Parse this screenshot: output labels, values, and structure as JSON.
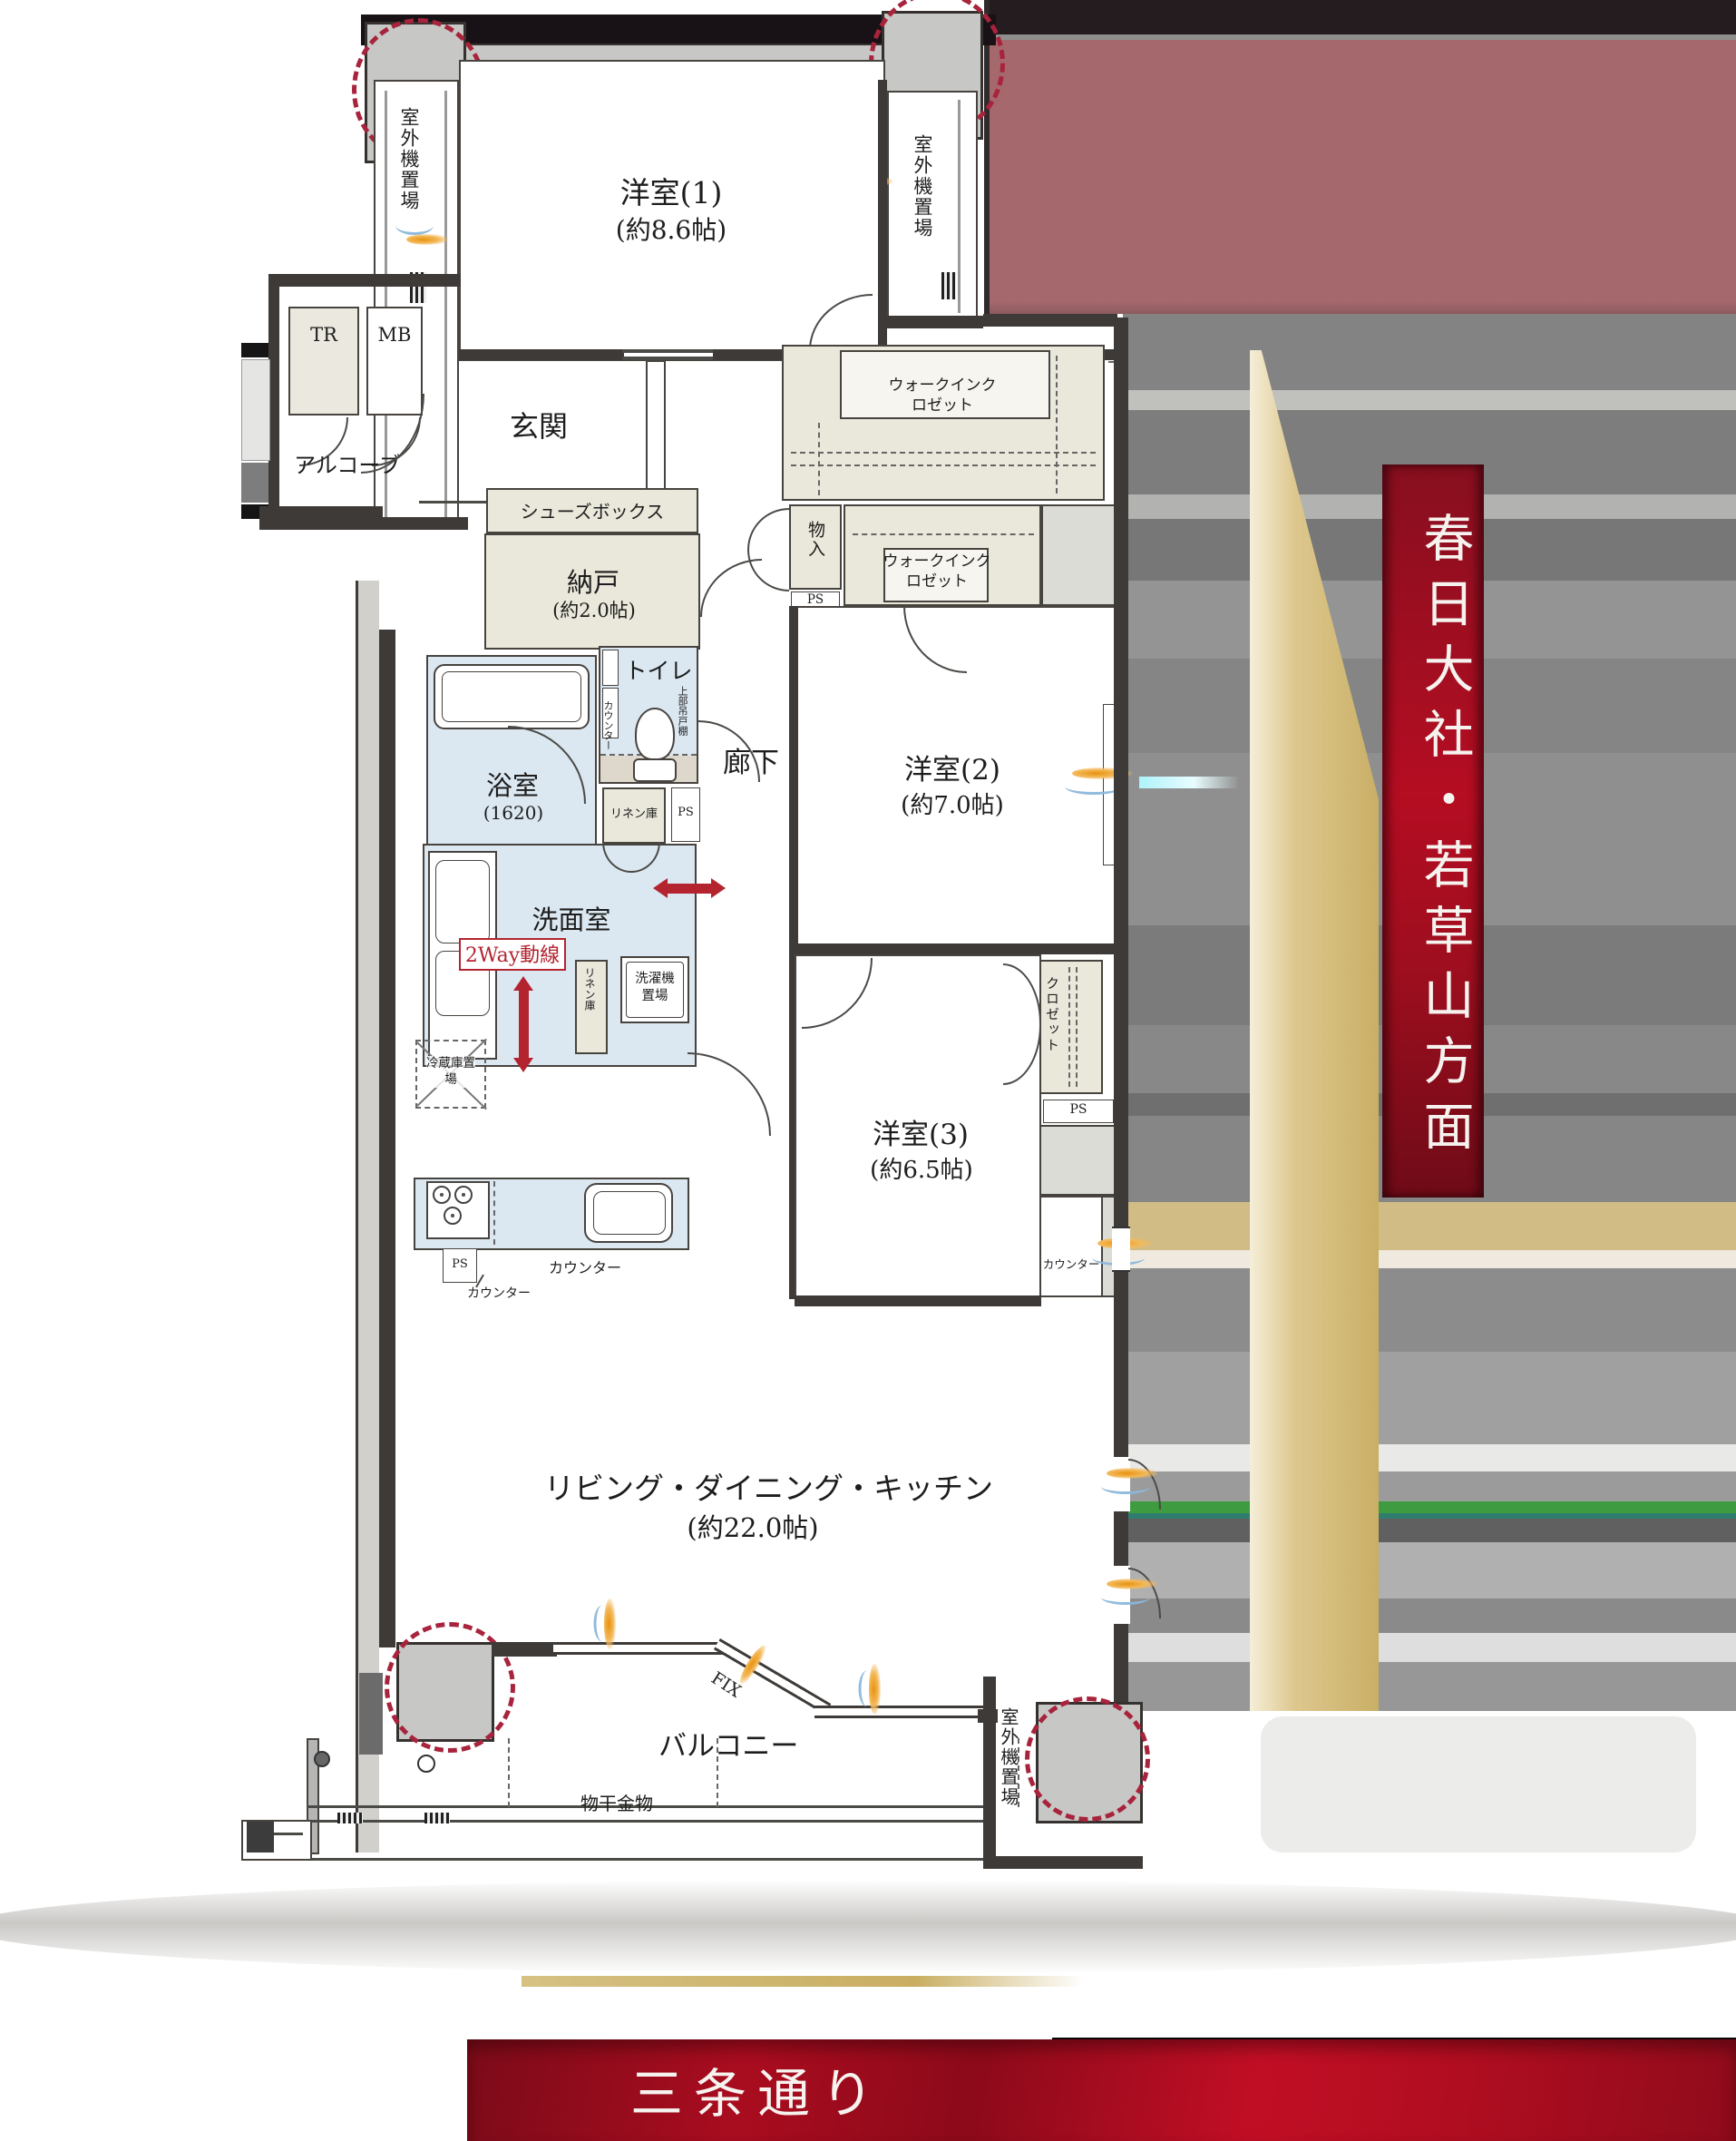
{
  "plan": {
    "rooms": {
      "western1": {
        "name": "洋室(1)",
        "size": "(約8.6帖)"
      },
      "western2": {
        "name": "洋室(2)",
        "size": "(約7.0帖)"
      },
      "western3": {
        "name": "洋室(3)",
        "size": "(約6.5帖)"
      },
      "ldk": {
        "name": "リビング・ダイニング・キッチン",
        "size": "(約22.0帖)"
      },
      "storeroom": {
        "name": "納戸",
        "size": "(約2.0帖)"
      },
      "bathroom": {
        "name": "浴室",
        "size": "(1620)"
      },
      "washroom": {
        "name": "洗面室"
      },
      "toilet": {
        "name": "トイレ"
      },
      "entrance": {
        "name": "玄関"
      },
      "alcove": {
        "name": "アルコーブ"
      },
      "hallway": {
        "name": "廊下"
      },
      "balcony": {
        "name": "バルコニー"
      }
    },
    "storage": {
      "walk_in_closet": "ウォークインクロゼット",
      "closet": "クロゼット",
      "storage_small": "物入",
      "shoe_box": "シューズボックス",
      "linen": "リネン庫",
      "washer": "洗濯機置場",
      "fridge": "冷蔵庫置場"
    },
    "equipment": {
      "tr": "TR",
      "mb": "MB",
      "ps": "PS",
      "counter": "カウンター",
      "upper_cabinet": "上部吊戸棚",
      "outdoor_unit": "室外機置場",
      "laundry_hardware": "物干金物"
    },
    "annotations": {
      "two_way": "2Way動線",
      "fix": "FIX"
    }
  },
  "banners": {
    "direction": "春日大社・若草山方面",
    "street": "三条通り"
  },
  "colors": {
    "accent_red": "#b3242f",
    "banner_red": "#b50d22",
    "wet_room_blue": "#dce8f1",
    "storage_beige": "#eae8db",
    "wall_dark": "#3e3a38",
    "pillar_gray": "#c7c7c5",
    "photo_mauve": "#a5696d",
    "photo_gold": "#cfb878",
    "photo_green": "#3f9b3f"
  }
}
